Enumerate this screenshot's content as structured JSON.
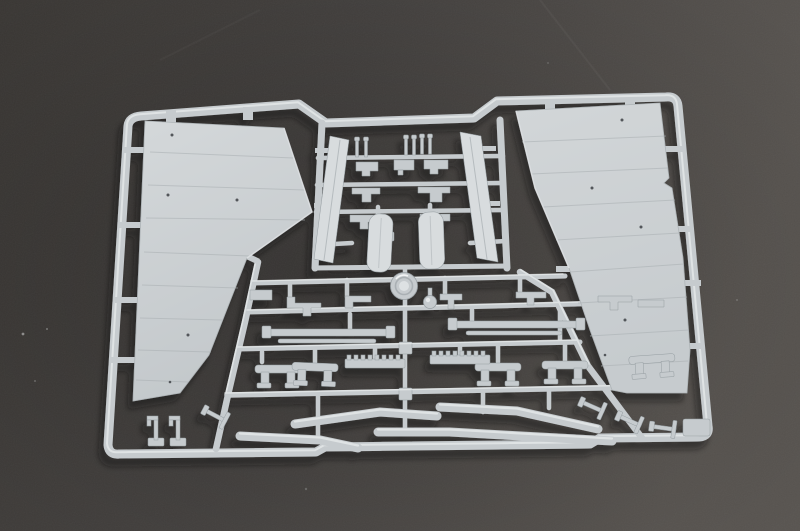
{
  "scene": {
    "subject": "overhead photograph of a light-gray injection-molded plastic model-kit sprue (parts tree)",
    "surface": "dark gray matte board, lighter toward the right edge",
    "lighting": "soft light from upper right casting shadows down-left of the sprue"
  },
  "colors": {
    "bg_dark": "#383533",
    "bg_mid": "#46433f",
    "bg_light": "#57534e",
    "plastic": "#c6cbce",
    "plastic_lt": "#d8dcde",
    "plastic_hi": "#ecefF0",
    "plastic_sh": "#959da1",
    "wing": "#ccd1d3",
    "wing_dk": "#b9bfc2",
    "panel_line": "#a9afb2",
    "cast_shadow": "#0a0a0a"
  },
  "parts": [
    {
      "name": "outer-frame",
      "desc": "rounded rectangular runner frame with stepped top and bottom rails"
    },
    {
      "name": "left-wing-panel",
      "desc": "large tapered wing skin panel with faint panel lines, upper left"
    },
    {
      "name": "right-wing-panel",
      "desc": "large tapered wing skin panel with faint panel lines, upper right"
    },
    {
      "name": "left-edge-strip",
      "desc": "long narrow strip part, center left"
    },
    {
      "name": "right-edge-strip",
      "desc": "long narrow strip part, center right"
    },
    {
      "name": "small-bracket-cluster",
      "desc": "grid of small brackets, clamps and upright pins, top center"
    },
    {
      "name": "left-door-paddle",
      "desc": "small rounded door panel, center"
    },
    {
      "name": "right-door-paddle",
      "desc": "small rounded door panel, center"
    },
    {
      "name": "hub-disc",
      "desc": "round domed disc part at sprue center"
    },
    {
      "name": "small-dome",
      "desc": "small round knob part beside the disc"
    },
    {
      "name": "linkage-row",
      "desc": "row of small angular linkage parts across the middle"
    },
    {
      "name": "flat-bar-left",
      "desc": "thin flat bar parts, mid left"
    },
    {
      "name": "flat-bar-right",
      "desc": "thin flat bar parts, mid right"
    },
    {
      "name": "bench-bracket-row",
      "desc": "five small two-legged mount parts, lower middle"
    },
    {
      "name": "tread-strip-left",
      "desc": "toothed grate strip, lower middle"
    },
    {
      "name": "tread-strip-right",
      "desc": "toothed grate strip, lower middle"
    },
    {
      "name": "tube-strips",
      "desc": "four long gently bent tubular strips along the bottom"
    },
    {
      "name": "hook-pins",
      "desc": "two small hooked pins standing on the bottom rail, lower left"
    },
    {
      "name": "t-shaped-parts",
      "desc": "small T-shaped parts near the bottom corners"
    },
    {
      "name": "corner-tab",
      "desc": "rectangular molding tab at the bottom-right corner"
    }
  ]
}
